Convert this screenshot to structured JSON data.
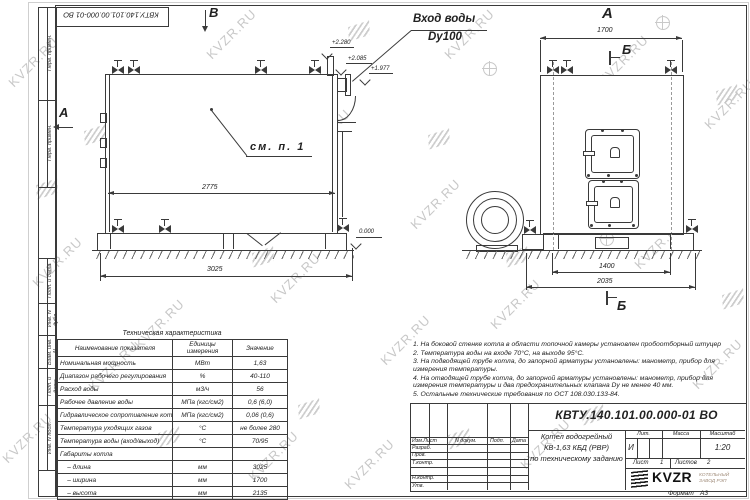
{
  "watermark": {
    "text": "KVZR.RU"
  },
  "stamp_top": "КВТУ.140.101.00.000-01 ВО",
  "frame_labels": {
    "top1": "Перв. примен.",
    "top2": "Перв. примен.",
    "mid1": "Подп. и дата",
    "mid2": "Инв. N дубл.",
    "mid3": "Взам. инв. N",
    "mid4": "Подп. и дата",
    "mid5": "Инв. N подл."
  },
  "left_view": {
    "view_marker_top": "В",
    "view_marker_left": "А",
    "inlet_label_1": "Вход воды",
    "inlet_label_2": "Dy100",
    "note_ref": "см. п. 1",
    "elev_1": "+2.280",
    "elev_2": "+2.085",
    "elev_3": "+1.977",
    "elev_0": "0.000",
    "dim_width_inner": "2775",
    "dim_width_outer": "3025"
  },
  "right_view": {
    "view_label": "А",
    "section_marker_top": "Б",
    "section_marker_bottom": "Б",
    "dim_top": "1700",
    "dim_bottom_inner": "1400",
    "dim_bottom_outer": "2035"
  },
  "table": {
    "title": "Техническая характеристика",
    "headers": [
      "Наименование показателя",
      "Единицы измерения",
      "Значение"
    ],
    "rows": [
      [
        "Номинальная мощность",
        "МВт",
        "1,63"
      ],
      [
        "Диапазон рабочего регулирования",
        "%",
        "40-110"
      ],
      [
        "Расход воды",
        "м3/ч",
        "56"
      ],
      [
        "Рабочее давление воды",
        "МПа (кгс/см2)",
        "0,6 (6,0)"
      ],
      [
        "Гидравлическое сопротивление котла",
        "МПа (кгс/см2)",
        "0,06 (0,6)"
      ],
      [
        "Температура уходящих газов",
        "°С",
        "не более 280"
      ],
      [
        "Температура воды (вход/выход)",
        "°С",
        "70/95"
      ],
      [
        "Габариты котла",
        "",
        ""
      ],
      [
        "    – длина",
        "мм",
        "3025"
      ],
      [
        "    – ширина",
        "мм",
        "1700"
      ],
      [
        "    – высота",
        "мм",
        "2135"
      ]
    ]
  },
  "notes": [
    "1.  На боковой стенке котла в области топочной камеры установлен пробоотборный штуцер",
    "2.  Температура воды на входе 70°С, на выходе 95°С.",
    "3.  На подводящей трубе котла, до запорной арматуры установлены: манометр, прибор для измерения температуры.",
    "4.  На отводящей трубе котла, до запорной арматуры установлены: манометр, прибор для измерения температуры и два предохранительных клапана Dу не менее 40 мм.",
    "5.  Остальные технические требования по ОСТ 108.030.133-84."
  ],
  "title_block": {
    "designation": "КВТУ.140.101.00.000-01 ВО",
    "doc_title_line1": "Котел водогрейный",
    "doc_title_line2": "КВ-1,63 КБД (РВР)",
    "doc_title_line3": "по техническому заданию",
    "col_izm": "Изм.Лист",
    "col_ndoc": "N докум.",
    "col_podp": "Подп.",
    "col_data": "Дата",
    "row_razrab": "Разраб.",
    "row_prov": "Пров.",
    "row_tkontr": "Т.контр.",
    "row_nkontr": "Н.контр.",
    "row_utv": "Утв.",
    "lit_header": "Лит.",
    "massa_header": "Масса",
    "masshtab_header": "Масштаб",
    "lit_value": "И",
    "scale_value": "1:20",
    "sheet_label": "Лист",
    "sheet_value": "1",
    "sheets_label": "Листов",
    "sheets_value": "2",
    "company_name": "KVZR",
    "company_sub1": "КОТЕЛЬНЫЙ",
    "company_sub2": "ЗАВОД РЭП",
    "format_label": "Формат",
    "format_value": "А3"
  },
  "colors": {
    "line": "#3a3a3a",
    "watermark": "#c8c8c8",
    "paper": "#ffffff"
  }
}
